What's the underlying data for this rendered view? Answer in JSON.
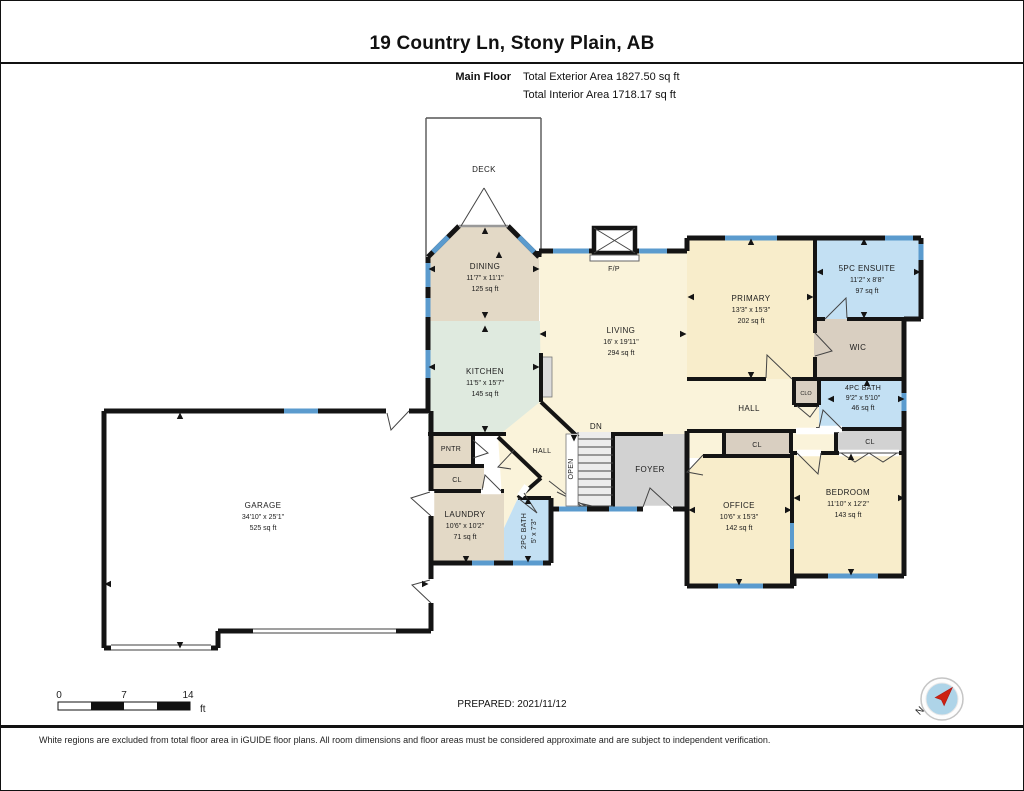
{
  "header": {
    "title": "19 Country Ln, Stony Plain, AB",
    "floor_label": "Main Floor",
    "exterior_area": "Total Exterior Area 1827.50 sq ft",
    "interior_area": "Total Interior Area 1718.17 sq ft"
  },
  "rooms": {
    "deck": {
      "name": "DECK"
    },
    "dining": {
      "name": "DINING",
      "dims": "11'7\" x 11'1\"",
      "area": "125 sq ft"
    },
    "kitchen": {
      "name": "KITCHEN",
      "dims": "11'5\" x 15'7\"",
      "area": "145 sq ft"
    },
    "living": {
      "name": "LIVING",
      "dims": "16' x 19'11\"",
      "area": "294 sq ft"
    },
    "fireplace": {
      "name": "F/P"
    },
    "primary": {
      "name": "PRIMARY",
      "dims": "13'3\" x 15'3\"",
      "area": "202 sq ft"
    },
    "ensuite": {
      "name": "5PC ENSUITE",
      "dims": "11'2\" x 8'8\"",
      "area": "97 sq ft"
    },
    "wic": {
      "name": "WIC"
    },
    "bath4": {
      "name": "4PC BATH",
      "dims": "9'2\" x 5'10\"",
      "area": "46 sq ft"
    },
    "clo": {
      "name": "CLO"
    },
    "hall": {
      "name": "HALL"
    },
    "hall_small": {
      "name": "HALL"
    },
    "stairs_dn": {
      "name": "DN"
    },
    "stairs_open": {
      "name": "OPEN"
    },
    "foyer": {
      "name": "FOYER"
    },
    "cl_bedroom": {
      "name": "CL"
    },
    "cl_office": {
      "name": "CL"
    },
    "cl_laundry": {
      "name": "CL"
    },
    "pantry": {
      "name": "PNTR"
    },
    "office": {
      "name": "OFFICE",
      "dims": "10'6\" x 15'3\"",
      "area": "142 sq ft"
    },
    "bedroom": {
      "name": "BEDROOM",
      "dims": "11'10\" x 12'2\"",
      "area": "143 sq ft"
    },
    "laundry": {
      "name": "LAUNDRY",
      "dims": "10'6\" x 10'2\"",
      "area": "71 sq ft"
    },
    "bath2": {
      "name": "2PC BATH",
      "dims": "5' x 7'3\""
    },
    "garage": {
      "name": "GARAGE",
      "dims": "34'10\" x 25'1\"",
      "area": "525 sq ft"
    }
  },
  "scale_bar": {
    "start": "0",
    "mid": "7",
    "end": "14",
    "unit": "ft"
  },
  "compass": {
    "north_label": "N"
  },
  "footer": {
    "prepared": "PREPARED: 2021/11/12",
    "disclaimer": "White regions are excluded from total floor area in iGUIDE floor plans. All room dimensions and floor areas must be considered approximate and are subject to independent verification."
  },
  "colors": {
    "wall": "#141414",
    "window": "#5b9bce",
    "cream": "#faf3da",
    "tan": "#e3d9c6",
    "tan_dark": "#d9cfc1",
    "mint": "#dfeadf",
    "wheat": "#f8edcb",
    "bath_blue": "#c3e0f3",
    "gray": "#d2d2d2",
    "stairs": "#ececec",
    "appliance": "#dcdcdc",
    "compass_blue": "#aed4e8",
    "compass_red": "#cc2211"
  }
}
